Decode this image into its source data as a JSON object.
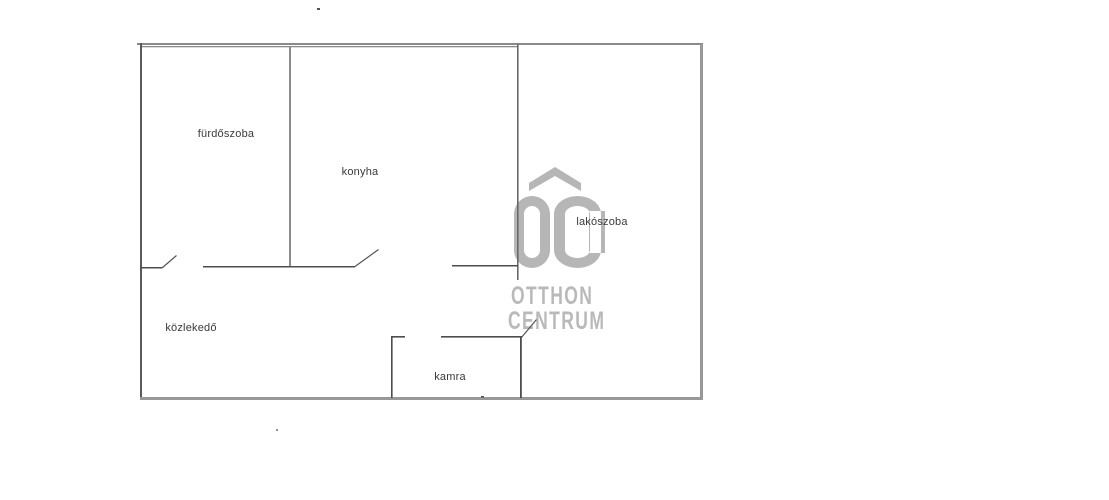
{
  "floorplan": {
    "rooms": [
      {
        "id": "furdoszoba",
        "name": "fürdőszoba"
      },
      {
        "id": "konyha",
        "name": "konyha"
      },
      {
        "id": "lakoszoba",
        "name": "lakószoba"
      },
      {
        "id": "kozlekedo",
        "name": "közlekedő"
      },
      {
        "id": "kamra",
        "name": "kamra"
      }
    ],
    "watermark": {
      "initials": "OC",
      "line1": "OTTHON",
      "line2": "CENTRUM",
      "color": "#b6b6b6"
    },
    "colors": {
      "background": "#ffffff",
      "wall_outer": "#989898",
      "wall_outer_top": "#8a8a8a",
      "wall_outer_left": "#595959",
      "wall_inner": "#4d4d4d",
      "wall_divider": "#8c8c8c",
      "wall_divider_dark": "#696969",
      "door_line": "#555555",
      "label_text": "#3a3a3a",
      "speck": "#555555",
      "speck_faint": "#919191"
    }
  }
}
